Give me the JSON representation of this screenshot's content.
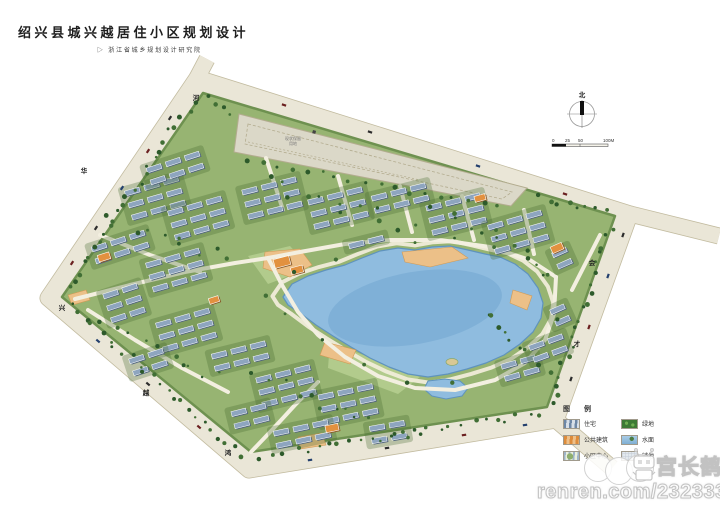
{
  "title": "绍兴县城兴越居住小区规划设计",
  "subtitle_marker": "▷",
  "subtitle": "浙江省城乡规划设计研究院",
  "compass": {
    "north_label": "北"
  },
  "scale_bar": {
    "l0": "0",
    "l1": "25",
    "l2": "50",
    "l3": "100M"
  },
  "parcel_label": {
    "line1": "现状保留",
    "line2": "用地",
    "x": 293,
    "y": 140
  },
  "road_labels": [
    {
      "ch": "河",
      "x": 196,
      "y": 100
    },
    {
      "ch": "华",
      "x": 84,
      "y": 173
    },
    {
      "ch": "兴",
      "x": 62,
      "y": 310
    },
    {
      "ch": "越",
      "x": 146,
      "y": 395
    },
    {
      "ch": "鸿",
      "x": 228,
      "y": 455
    },
    {
      "ch": "会",
      "x": 592,
      "y": 265
    },
    {
      "ch": "才",
      "x": 577,
      "y": 346
    }
  ],
  "legend": {
    "title": "图 例",
    "items": [
      {
        "label": "住宅",
        "type": "res"
      },
      {
        "label": "绿地",
        "type": "green"
      },
      {
        "label": "公共建筑",
        "type": "pub"
      },
      {
        "label": "水面",
        "type": "water"
      },
      {
        "label": "小区中心",
        "type": "center"
      },
      {
        "label": "铺地",
        "type": "paving"
      }
    ]
  },
  "watermark": {
    "name": "宫长鹤",
    "url": "renren.com/232333316"
  },
  "map": {
    "colors": {
      "road_fill": "#eae6d7",
      "road_edge": "#c2bb9f",
      "grass": "#97b472",
      "grass_edge": "#6e9150",
      "lake": "#8fbcdf",
      "lake_deep": "#7aadd4",
      "lake_edge": "#5f93bd",
      "shore_path": "#f0ecd9",
      "lawn": "#b6cf90",
      "sand": "#ecc088",
      "sand_edge": "#d19a54",
      "path": "#f3efe0",
      "roof_res": "#8ea5bf",
      "roof_res_shadow": "#52667f",
      "roof_pub": "#e2913f",
      "roof_pub_shadow": "#8a5a28",
      "tree_dark": "#2d5a2b",
      "tree_mid": "#416f35",
      "parcel": "#dbd8c8",
      "parcel_edge": "#b3ac8f",
      "island": "#d8c894"
    },
    "road_loop": [
      [
        197,
        78
      ],
      [
        48,
        298
      ],
      [
        249,
        470
      ],
      [
        556,
        420
      ],
      [
        630,
        214
      ]
    ],
    "road_stubs": [
      [
        [
          630,
          214
        ],
        [
          719,
          236
        ]
      ],
      [
        [
          556,
          420
        ],
        [
          612,
          468
        ]
      ],
      [
        [
          197,
          78
        ],
        [
          207,
          59
        ]
      ]
    ],
    "site": [
      [
        203,
        93
      ],
      [
        62,
        297
      ],
      [
        251,
        452
      ],
      [
        547,
        407
      ],
      [
        615,
        216
      ]
    ],
    "parcel": [
      [
        239,
        114
      ],
      [
        527,
        188
      ],
      [
        511,
        206
      ],
      [
        234,
        152
      ]
    ],
    "parcel_inner": [
      [
        248,
        124
      ],
      [
        512,
        192
      ],
      [
        502,
        199
      ],
      [
        245,
        144
      ]
    ],
    "parcel_diag": [
      [
        248,
        142
      ],
      [
        420,
        180
      ]
    ],
    "marker": [
      313,
      130
    ],
    "lake": [
      [
        283,
        297
      ],
      [
        292,
        284
      ],
      [
        308,
        276
      ],
      [
        326,
        270
      ],
      [
        345,
        265
      ],
      [
        362,
        258
      ],
      [
        380,
        251
      ],
      [
        398,
        248
      ],
      [
        415,
        250
      ],
      [
        432,
        247
      ],
      [
        450,
        246
      ],
      [
        468,
        250
      ],
      [
        485,
        254
      ],
      [
        500,
        257
      ],
      [
        515,
        264
      ],
      [
        528,
        274
      ],
      [
        538,
        288
      ],
      [
        543,
        303
      ],
      [
        541,
        318
      ],
      [
        533,
        332
      ],
      [
        520,
        344
      ],
      [
        504,
        355
      ],
      [
        486,
        363
      ],
      [
        467,
        369
      ],
      [
        448,
        374
      ],
      [
        428,
        377
      ],
      [
        408,
        374
      ],
      [
        389,
        367
      ],
      [
        370,
        358
      ],
      [
        351,
        347
      ],
      [
        333,
        336
      ],
      [
        316,
        325
      ],
      [
        300,
        313
      ],
      [
        288,
        305
      ]
    ],
    "lake_center": [
      415,
      307
    ],
    "deep": [
      415,
      308,
      88,
      36
    ],
    "pond": [
      [
        428,
        381
      ],
      [
        445,
        379
      ],
      [
        460,
        381
      ],
      [
        468,
        388
      ],
      [
        462,
        396
      ],
      [
        446,
        399
      ],
      [
        432,
        396
      ],
      [
        424,
        389
      ]
    ],
    "island": [
      452,
      362,
      6,
      3.5
    ],
    "lawns": [
      [
        [
          468,
          256
        ],
        [
          520,
          266
        ],
        [
          540,
          292
        ],
        [
          508,
          296
        ],
        [
          468,
          272
        ]
      ],
      [
        [
          248,
          256
        ],
        [
          290,
          246
        ],
        [
          310,
          268
        ],
        [
          268,
          284
        ]
      ],
      [
        [
          330,
          342
        ],
        [
          420,
          377
        ],
        [
          398,
          394
        ],
        [
          328,
          368
        ]
      ]
    ],
    "sand": [
      [
        [
          265,
          252
        ],
        [
          300,
          249
        ],
        [
          312,
          265
        ],
        [
          290,
          277
        ],
        [
          263,
          268
        ]
      ],
      [
        [
          402,
          252
        ],
        [
          452,
          247
        ],
        [
          468,
          258
        ],
        [
          430,
          267
        ],
        [
          405,
          262
        ]
      ],
      [
        [
          325,
          342
        ],
        [
          356,
          350
        ],
        [
          350,
          364
        ],
        [
          320,
          355
        ]
      ],
      [
        [
          513,
          290
        ],
        [
          532,
          296
        ],
        [
          527,
          310
        ],
        [
          510,
          303
        ]
      ],
      [
        [
          298,
          437
        ],
        [
          322,
          433
        ],
        [
          326,
          445
        ],
        [
          300,
          449
        ]
      ],
      [
        [
          68,
          295
        ],
        [
          86,
          290
        ],
        [
          90,
          300
        ],
        [
          72,
          305
        ]
      ]
    ],
    "paths": [
      [
        [
          75,
          299
        ],
        [
          130,
          285
        ],
        [
          185,
          272
        ],
        [
          235,
          263
        ],
        [
          268,
          258
        ]
      ],
      [
        [
          268,
          258
        ],
        [
          300,
          252
        ],
        [
          345,
          244
        ],
        [
          390,
          240
        ],
        [
          440,
          240
        ],
        [
          490,
          247
        ],
        [
          530,
          260
        ],
        [
          556,
          277
        ]
      ],
      [
        [
          268,
          258
        ],
        [
          282,
          285
        ],
        [
          298,
          312
        ],
        [
          318,
          335
        ],
        [
          345,
          357
        ],
        [
          378,
          376
        ],
        [
          415,
          388
        ],
        [
          455,
          390
        ],
        [
          495,
          380
        ],
        [
          525,
          363
        ],
        [
          545,
          340
        ],
        [
          554,
          314
        ],
        [
          556,
          277
        ]
      ],
      [
        [
          251,
          452
        ],
        [
          272,
          430
        ],
        [
          295,
          405
        ],
        [
          318,
          382
        ]
      ],
      [
        [
          100,
          235
        ],
        [
          150,
          255
        ],
        [
          200,
          272
        ]
      ],
      [
        [
          88,
          310
        ],
        [
          135,
          340
        ],
        [
          182,
          368
        ],
        [
          228,
          392
        ]
      ],
      [
        [
          266,
          158
        ],
        [
          283,
          210
        ]
      ],
      [
        [
          338,
          176
        ],
        [
          352,
          225
        ]
      ],
      [
        [
          400,
          186
        ],
        [
          412,
          232
        ]
      ],
      [
        [
          462,
          196
        ],
        [
          474,
          240
        ]
      ],
      [
        [
          524,
          210
        ],
        [
          534,
          254
        ]
      ],
      [
        [
          600,
          235
        ],
        [
          572,
          290
        ]
      ]
    ],
    "unit": {
      "w": 15,
      "h": 5,
      "gx": 5,
      "gy": 7.5
    },
    "clusters": [
      [
        155,
        198,
        3,
        3,
        -16
      ],
      [
        198,
        218,
        3,
        3,
        -16
      ],
      [
        120,
        247,
        2,
        3,
        -18
      ],
      [
        176,
        270,
        3,
        3,
        -16
      ],
      [
        124,
        303,
        3,
        2,
        -18
      ],
      [
        186,
        330,
        3,
        3,
        -16
      ],
      [
        240,
        356,
        2,
        3,
        -14
      ],
      [
        148,
        362,
        2,
        2,
        -18
      ],
      [
        272,
        198,
        3,
        3,
        -14
      ],
      [
        338,
        208,
        3,
        3,
        -14
      ],
      [
        400,
        198,
        2,
        3,
        -14
      ],
      [
        366,
        242,
        1,
        2,
        -14
      ],
      [
        456,
        214,
        3,
        3,
        -14
      ],
      [
        518,
        232,
        3,
        3,
        -16
      ],
      [
        562,
        258,
        2,
        1,
        -24
      ],
      [
        560,
        315,
        2,
        1,
        -24
      ],
      [
        520,
        368,
        2,
        2,
        -16
      ],
      [
        548,
        348,
        2,
        2,
        -20
      ],
      [
        286,
        386,
        3,
        3,
        -14
      ],
      [
        348,
        404,
        3,
        3,
        -12
      ],
      [
        302,
        434,
        2,
        3,
        -12
      ],
      [
        388,
        432,
        2,
        2,
        -10
      ],
      [
        250,
        416,
        2,
        2,
        -14
      ],
      [
        175,
        168,
        2,
        3,
        -18
      ]
    ],
    "public": [
      [
        282,
        262,
        16,
        9,
        -15
      ],
      [
        297,
        270,
        12,
        7,
        -15
      ],
      [
        104,
        257,
        12,
        7,
        -18
      ],
      [
        557,
        248,
        12,
        7,
        -24
      ],
      [
        332,
        428,
        13,
        7,
        -12
      ],
      [
        480,
        198,
        11,
        6,
        -15
      ],
      [
        214,
        300,
        10,
        6,
        -18
      ]
    ],
    "tree_strips": [
      [
        196,
        96,
        66,
        292,
        24,
        4
      ],
      [
        68,
        304,
        244,
        458,
        24,
        4
      ],
      [
        256,
        458,
        546,
        412,
        26,
        4
      ],
      [
        550,
        408,
        612,
        222,
        20,
        4
      ],
      [
        534,
        196,
        612,
        214,
        8,
        3
      ],
      [
        206,
        96,
        236,
        118,
        4,
        3
      ],
      [
        240,
        158,
        505,
        210,
        18,
        3
      ],
      [
        100,
        215,
        230,
        262,
        10,
        8
      ],
      [
        100,
        322,
        225,
        382,
        10,
        8
      ],
      [
        258,
        182,
        420,
        228,
        12,
        8
      ],
      [
        432,
        200,
        556,
        282,
        12,
        8
      ],
      [
        252,
        372,
        420,
        440,
        13,
        8
      ],
      [
        478,
        304,
        552,
        382,
        10,
        8
      ]
    ],
    "cars": [
      [
        170,
        118,
        124
      ],
      [
        148,
        151,
        124
      ],
      [
        122,
        188,
        124
      ],
      [
        96,
        228,
        124
      ],
      [
        72,
        263,
        124
      ],
      [
        98,
        341,
        40
      ],
      [
        148,
        384,
        40
      ],
      [
        199,
        427,
        40
      ],
      [
        310,
        460,
        -9
      ],
      [
        387,
        448,
        -9
      ],
      [
        464,
        435,
        -9
      ],
      [
        525,
        425,
        -9
      ],
      [
        571,
        379,
        -70
      ],
      [
        589,
        327,
        -70
      ],
      [
        608,
        276,
        -70
      ],
      [
        623,
        235,
        -70
      ],
      [
        565,
        194,
        17
      ],
      [
        478,
        166,
        17
      ],
      [
        370,
        132,
        17
      ],
      [
        284,
        105,
        17
      ]
    ]
  }
}
